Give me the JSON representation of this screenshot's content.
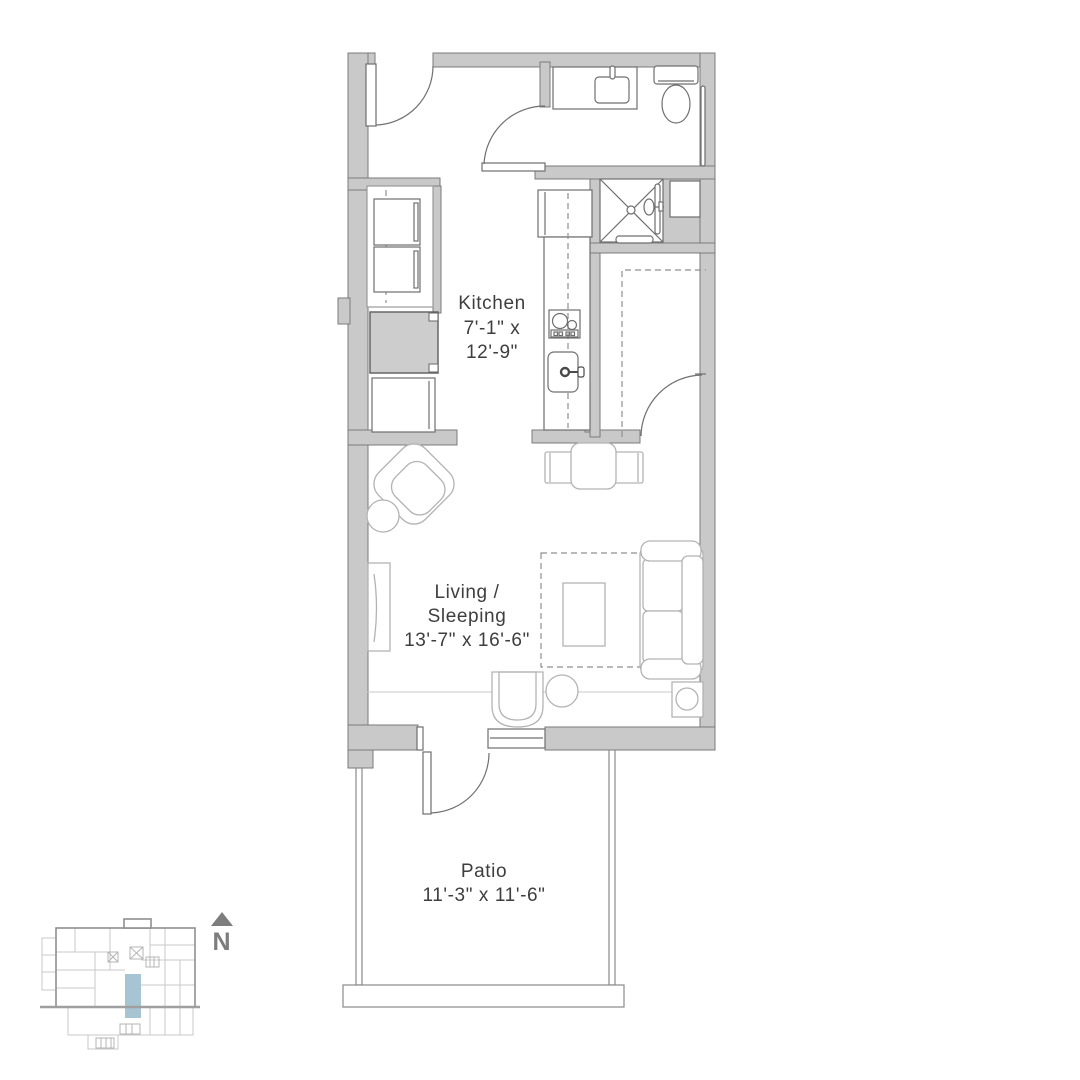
{
  "plan": {
    "rooms": [
      {
        "id": "kitchen",
        "name": "Kitchen",
        "dimensions": "7'-1\" x 12'-9\""
      },
      {
        "id": "living",
        "name": "Living / Sleeping",
        "dimensions": "13'-7\" x 16'-6\""
      },
      {
        "id": "patio",
        "name": "Patio",
        "dimensions": "11'-3\" x 11'-6\""
      }
    ],
    "labels": {
      "kitchen_name": "Kitchen",
      "kitchen_dims_line1": "7'-1\" x",
      "kitchen_dims_line2": "12'-9\"",
      "living_name_line1": "Living /",
      "living_name_line2": "Sleeping",
      "living_dims": "13'-7\" x 16'-6\"",
      "patio_name": "Patio",
      "patio_dims": "11'-3\" x 11'-6\""
    },
    "fixtures": [
      "entry-door",
      "bathroom-vanity",
      "bathroom-sink",
      "toilet",
      "towel-bar",
      "shower",
      "linen-cabinet",
      "washer-dryer-stack",
      "utility-chase",
      "refrigerator",
      "kitchen-counter",
      "cooktop",
      "kitchen-sink",
      "closet-rods",
      "closet-door",
      "dining-table",
      "dining-chairs",
      "armchair",
      "side-table",
      "tv-console",
      "rug",
      "coffee-table",
      "sofa-bed",
      "lounge-chair",
      "ottoman",
      "lamp-table",
      "patio-door",
      "window"
    ],
    "compass": {
      "north_label": "N"
    },
    "key_plan": {
      "highlight_color": "#a7c4d3"
    },
    "colors": {
      "wall": "#c9c9c9",
      "wall_outline": "#7a7a7a",
      "fixture_line": "#6f6f6f",
      "furniture_line": "#b3b3b3",
      "text": "#3e3e3e",
      "north_arrow": "#7d7d7d",
      "unit_highlight": "#a7c4d3"
    }
  }
}
